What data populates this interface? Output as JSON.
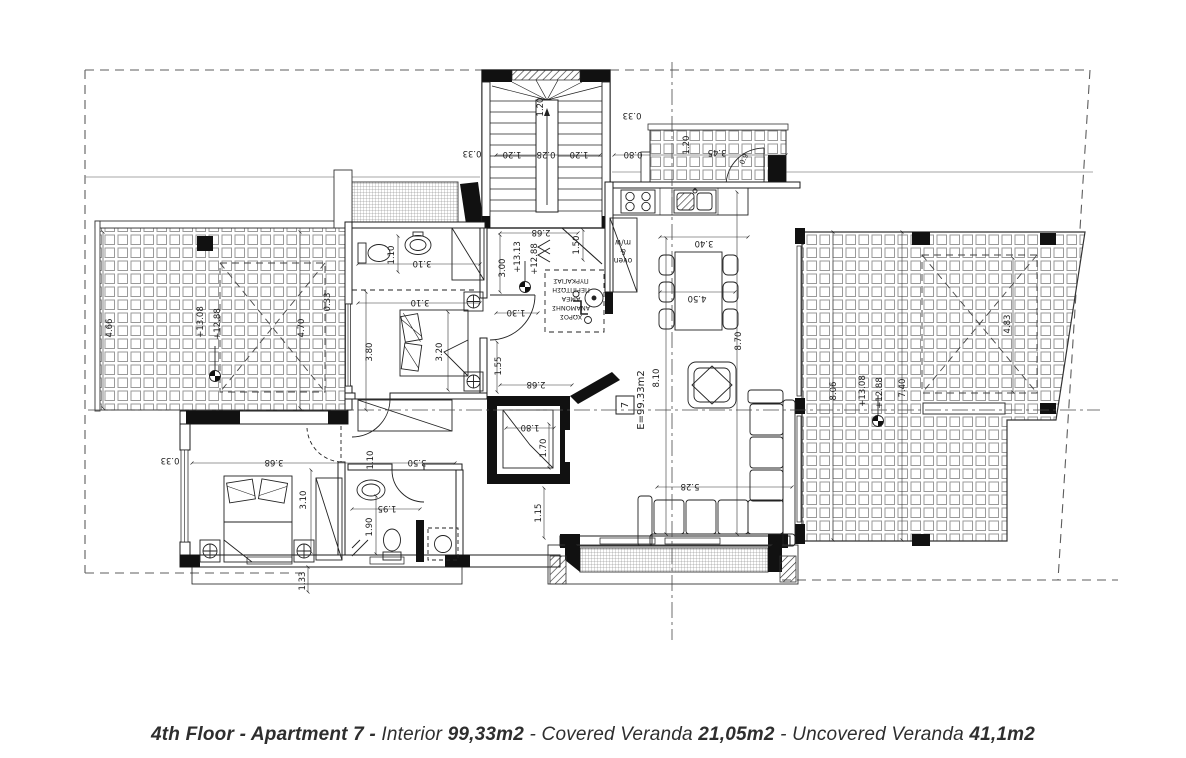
{
  "caption": {
    "parts": [
      {
        "text": "4th Floor - Apartment 7 - ",
        "bold": true
      },
      {
        "text": "Interior ",
        "bold": false
      },
      {
        "text": "99,33m2",
        "bold": true
      },
      {
        "text": " - ",
        "bold": false
      },
      {
        "text": "Covered Veranda ",
        "bold": false
      },
      {
        "text": "21,05m2",
        "bold": true
      },
      {
        "text": " - ",
        "bold": false
      },
      {
        "text": "Uncovered Veranda ",
        "bold": false
      },
      {
        "text": "41,1m2",
        "bold": true
      }
    ]
  },
  "colors": {
    "ink": "#1b1b1b",
    "background": "#ffffff"
  },
  "plan": {
    "apartment_number": "7",
    "area_label": "E=99.33m2",
    "labels": [
      {
        "t": "0.33",
        "x": 472,
        "y": 151,
        "r": 180
      },
      {
        "t": "1.20",
        "x": 543,
        "y": 107,
        "r": -90
      },
      {
        "t": "1.20",
        "x": 512,
        "y": 152,
        "r": 180
      },
      {
        "t": "0.28",
        "x": 546,
        "y": 152,
        "r": 180
      },
      {
        "t": "1.20",
        "x": 579,
        "y": 152,
        "r": 180
      },
      {
        "t": "0.33",
        "x": 632,
        "y": 113,
        "r": 180
      },
      {
        "t": "0.80",
        "x": 633,
        "y": 152,
        "r": 180
      },
      {
        "t": "1.20",
        "x": 689,
        "y": 145,
        "r": -90
      },
      {
        "t": "3.45",
        "x": 717,
        "y": 150,
        "r": 180
      },
      {
        "t": "0.9",
        "x": 746,
        "y": 160,
        "r": -65,
        "s": 7
      },
      {
        "t": "4.66",
        "x": 112,
        "y": 328,
        "r": -90
      },
      {
        "t": "+13.08",
        "x": 203,
        "y": 322,
        "r": -90
      },
      {
        "t": "+12.88",
        "x": 220,
        "y": 324,
        "r": -90
      },
      {
        "t": "4.70",
        "x": 304,
        "y": 328,
        "r": -90
      },
      {
        "t": "0.33",
        "x": 330,
        "y": 302,
        "r": -90
      },
      {
        "t": "2.68",
        "x": 541,
        "y": 230,
        "r": 180
      },
      {
        "t": "1.50",
        "x": 579,
        "y": 245,
        "r": -90
      },
      {
        "t": "3.00",
        "x": 505,
        "y": 268,
        "r": -90
      },
      {
        "t": "+13.13",
        "x": 520,
        "y": 257,
        "r": -90
      },
      {
        "t": "+12.88",
        "x": 537,
        "y": 259,
        "r": -90
      },
      {
        "t": "1.30",
        "x": 516,
        "y": 310,
        "r": 180
      },
      {
        "t": "ΠΥΡΚΑΓΙΑΣ",
        "x": 571,
        "y": 279,
        "r": 180,
        "s": 6.5
      },
      {
        "t": "ΠΕΡΙΠΤΩΣΗ",
        "x": 571,
        "y": 288,
        "r": 180,
        "s": 6.5
      },
      {
        "t": "ΑΜΕΑ",
        "x": 571,
        "y": 297,
        "r": 180,
        "s": 6.5
      },
      {
        "t": "ΑΝΑΜΟΝΗΣ",
        "x": 571,
        "y": 306,
        "r": 180,
        "s": 6.5
      },
      {
        "t": "ΧΩΡΟΣ",
        "x": 571,
        "y": 315,
        "r": 180,
        "s": 6.5
      },
      {
        "t": "m/w",
        "x": 623,
        "y": 240,
        "r": 180,
        "s": 7.5
      },
      {
        "t": "&",
        "x": 623,
        "y": 249,
        "r": 180,
        "s": 7.5
      },
      {
        "t": "oven",
        "x": 623,
        "y": 258,
        "r": 180,
        "s": 7.5
      },
      {
        "t": "1.55",
        "x": 501,
        "y": 366,
        "r": -90
      },
      {
        "t": "2.68",
        "x": 536,
        "y": 382,
        "r": 180
      },
      {
        "t": "8.10",
        "x": 659,
        "y": 378,
        "r": -90
      },
      {
        "t": "1.80",
        "x": 530,
        "y": 425,
        "r": 180
      },
      {
        "t": "1.70",
        "x": 546,
        "y": 448,
        "r": -90
      },
      {
        "t": "1.15",
        "x": 541,
        "y": 513,
        "r": -90
      },
      {
        "t": "3.40",
        "x": 704,
        "y": 241,
        "r": 180
      },
      {
        "t": "4.50",
        "x": 697,
        "y": 296,
        "r": 180
      },
      {
        "t": "8.70",
        "x": 741,
        "y": 341,
        "r": -90
      },
      {
        "t": "5.28",
        "x": 690,
        "y": 484,
        "r": 180
      },
      {
        "t": "8.06",
        "x": 836,
        "y": 391,
        "r": -90
      },
      {
        "t": "+13.08",
        "x": 865,
        "y": 391,
        "r": -90
      },
      {
        "t": "+12.88",
        "x": 882,
        "y": 393,
        "r": -90
      },
      {
        "t": "7.40",
        "x": 905,
        "y": 388,
        "r": -90
      },
      {
        "t": "4.83",
        "x": 1010,
        "y": 324,
        "r": -90
      },
      {
        "t": "1.10",
        "x": 394,
        "y": 255,
        "r": -90
      },
      {
        "t": "3.10",
        "x": 422,
        "y": 261,
        "r": 180
      },
      {
        "t": "3.10",
        "x": 420,
        "y": 300,
        "r": 180
      },
      {
        "t": "3.80",
        "x": 372,
        "y": 352,
        "r": -90
      },
      {
        "t": "3.20",
        "x": 442,
        "y": 352,
        "r": -90
      },
      {
        "t": "0.33",
        "x": 170,
        "y": 458,
        "r": 180
      },
      {
        "t": "3.68",
        "x": 274,
        "y": 460,
        "r": 180
      },
      {
        "t": "1.10",
        "x": 373,
        "y": 460,
        "r": -90
      },
      {
        "t": "3.50",
        "x": 417,
        "y": 460,
        "r": 180
      },
      {
        "t": "3.10",
        "x": 306,
        "y": 500,
        "r": -90
      },
      {
        "t": "1.95",
        "x": 387,
        "y": 506,
        "r": 180
      },
      {
        "t": "1.90",
        "x": 372,
        "y": 527,
        "r": -90
      },
      {
        "t": "1.33",
        "x": 305,
        "y": 581,
        "r": -90
      }
    ]
  }
}
